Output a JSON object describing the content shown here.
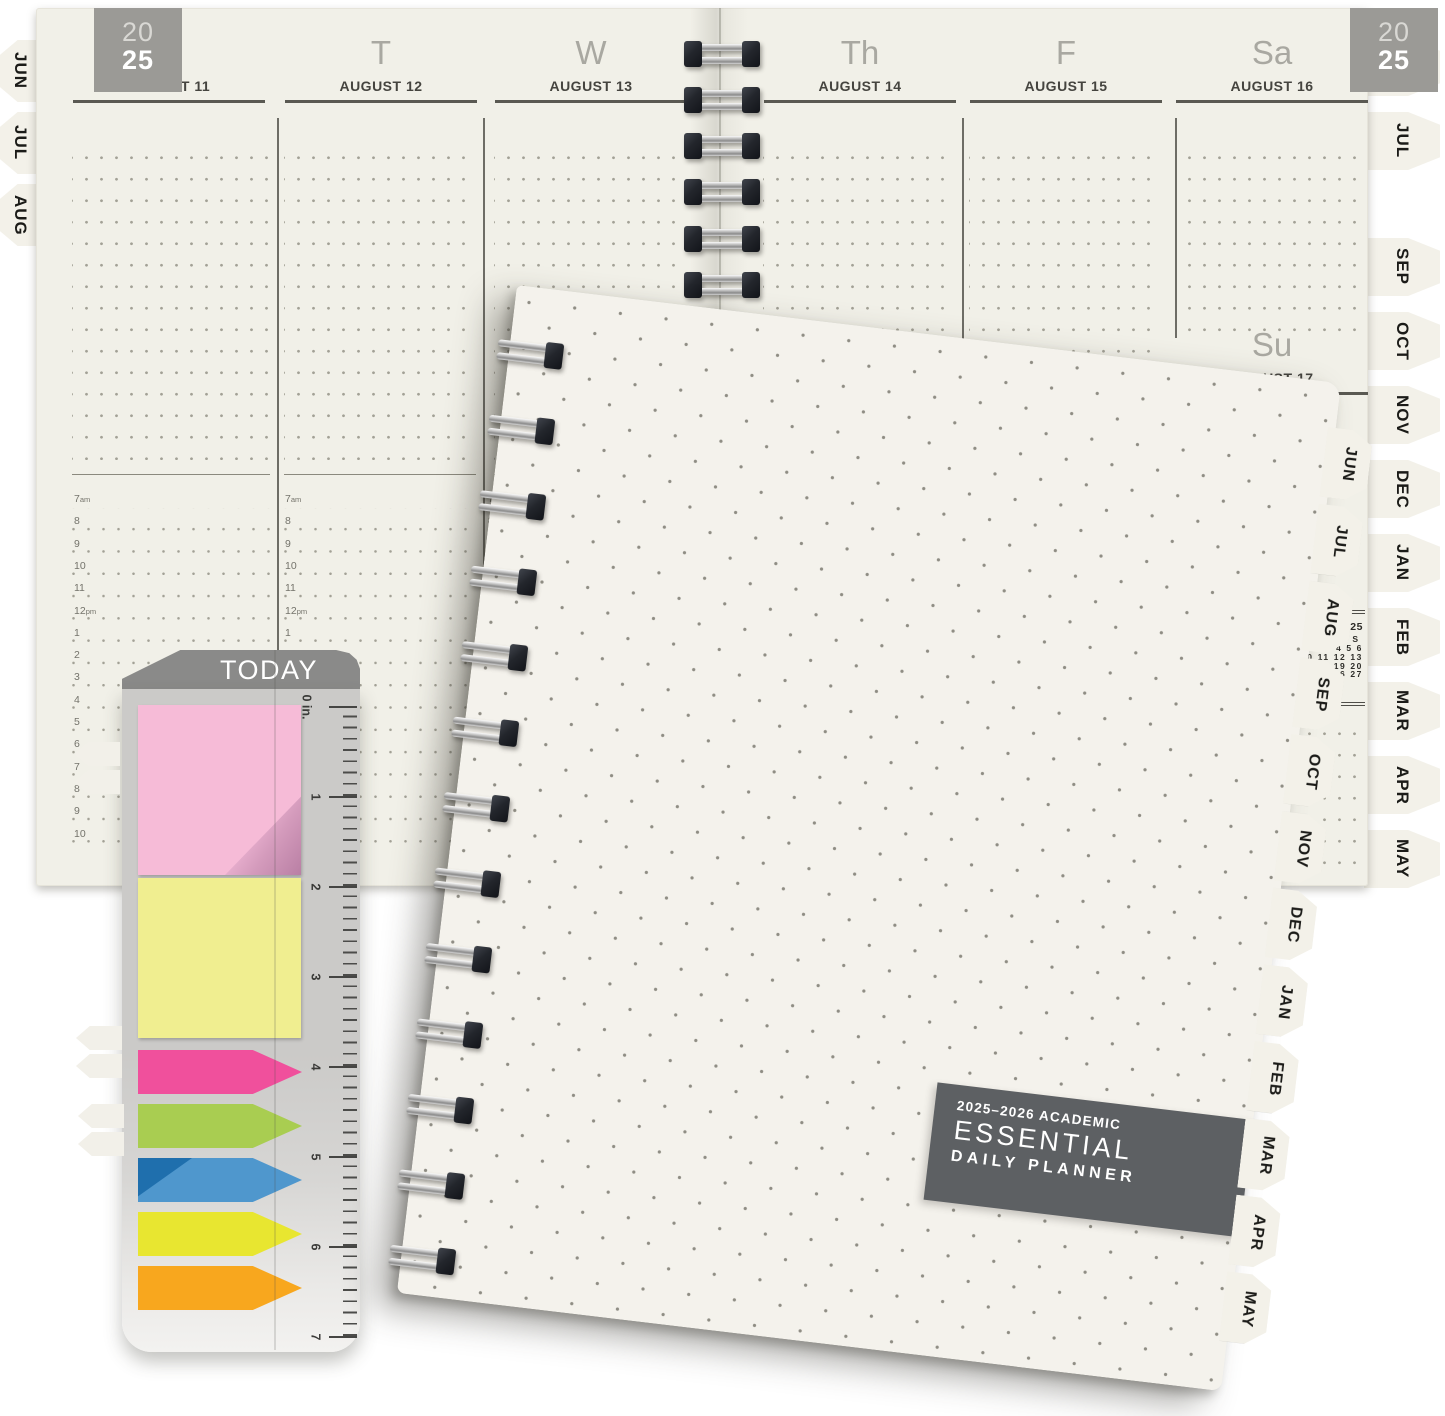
{
  "year_badge": {
    "top": "20",
    "bottom": "25"
  },
  "spread": {
    "left_tabs": [
      "JUN",
      "JUL",
      "AUG"
    ],
    "right_tabs": [
      "JUN",
      "JUL",
      "SEP",
      "OCT",
      "NOV",
      "DEC",
      "JAN",
      "FEB",
      "MAR",
      "APR",
      "MAY"
    ],
    "days": [
      {
        "abbr": "M",
        "date": "AUGUST 11"
      },
      {
        "abbr": "T",
        "date": "AUGUST 12"
      },
      {
        "abbr": "W",
        "date": "AUGUST 13"
      },
      {
        "abbr": "Th",
        "date": "AUGUST 14"
      },
      {
        "abbr": "F",
        "date": "AUGUST 15"
      },
      {
        "abbr": "Sa",
        "date": "AUGUST 16"
      }
    ],
    "sunday": {
      "abbr": "Su",
      "date": "AUGUST 17"
    },
    "time_slots": [
      "7am",
      "8",
      "9",
      "10",
      "11",
      "12pm",
      "1",
      "2",
      "3",
      "4",
      "5",
      "6",
      "7",
      "8",
      "9",
      "10"
    ],
    "mini_calendar": {
      "title_visible": "ER 2025",
      "weekday_headers_visible": "T F S",
      "weeks_visible": [
        "3 4 5 6",
        "10 11 12 13",
        "17 18 19 20",
        "24 25 26 27"
      ]
    }
  },
  "cover": {
    "label_line1": "2025–2026 ACADEMIC",
    "label_line2": "ESSENTIAL",
    "label_line3": "DAILY PLANNER",
    "tabs": [
      "JUN",
      "JUL",
      "AUG",
      "SEP",
      "OCT",
      "NOV",
      "DEC",
      "JAN",
      "FEB",
      "MAR",
      "APR",
      "MAY"
    ]
  },
  "ruler": {
    "title": "TODAY",
    "scale_labels": [
      "0 in.",
      "1",
      "2",
      "3",
      "4",
      "5",
      "6",
      "7"
    ],
    "sticky_notes": [
      {
        "name": "pink-sticky-note",
        "color": "#f6bbd7"
      },
      {
        "name": "yellow-sticky-note",
        "color": "#f0ee90"
      }
    ],
    "flags": [
      {
        "name": "pink-flag",
        "color": "#f0509c"
      },
      {
        "name": "green-flag",
        "color": "#a9cd51"
      },
      {
        "name": "blue-flag",
        "color": "#4f97cd"
      },
      {
        "name": "yellow-flag",
        "color": "#e8e630"
      },
      {
        "name": "orange-flag",
        "color": "#f8a71e"
      }
    ]
  },
  "colors": {
    "page_cream": "#f1f0e8",
    "cover_cream": "#f4f2ec",
    "label_gray": "#5d6063",
    "badge_gray": "#9b9a96",
    "ruler_header_gray": "#8a8a89",
    "ruler_body_gray": "#cbcac8"
  }
}
